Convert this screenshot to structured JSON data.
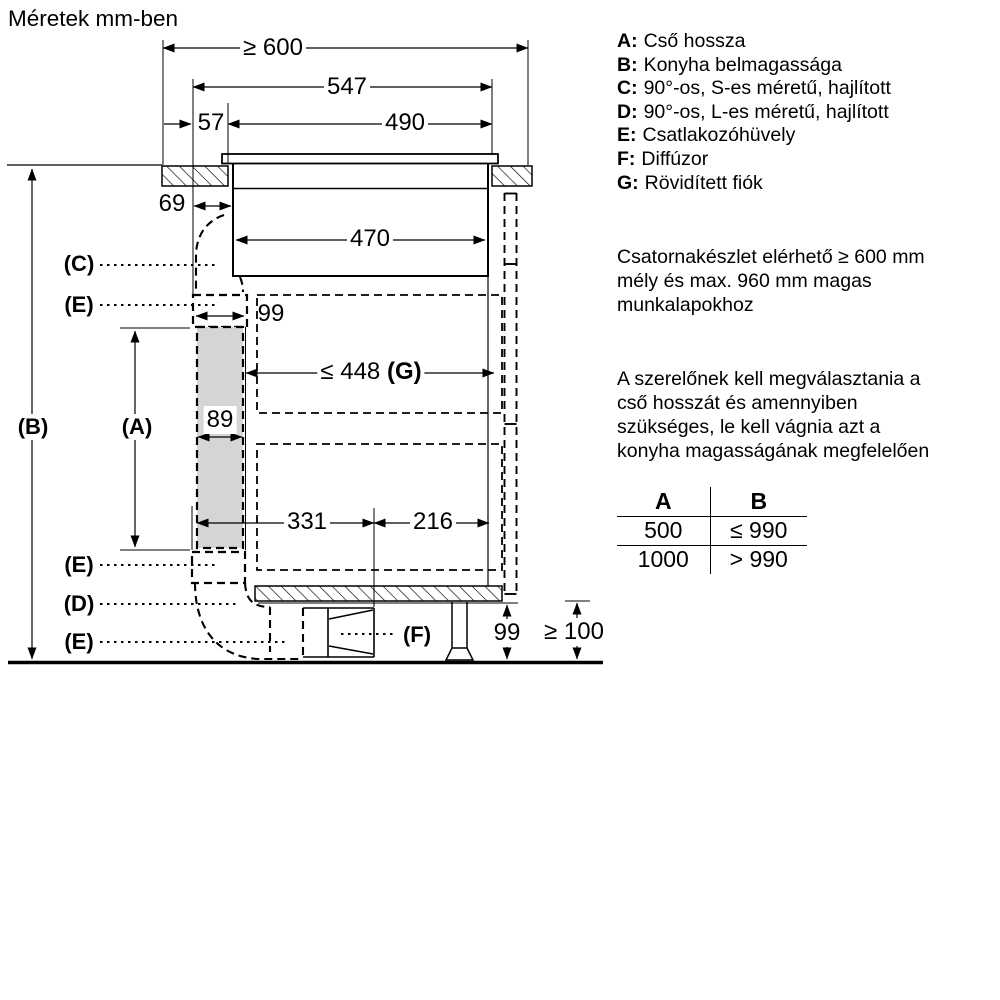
{
  "title": "Méretek mm-ben",
  "legend": {
    "items": [
      {
        "key": "A:",
        "text": "Cső hossza"
      },
      {
        "key": "B:",
        "text": "Konyha belmagassága"
      },
      {
        "key": "C:",
        "text": "90°-os, S-es méretű, hajlított"
      },
      {
        "key": "D:",
        "text": "90°-os, L-es méretű, hajlított"
      },
      {
        "key": "E:",
        "text": "Csatlakozóhüvely"
      },
      {
        "key": "F:",
        "text": "Diffúzor"
      },
      {
        "key": "G:",
        "text": "Rövidített fiók"
      }
    ]
  },
  "notes": {
    "note1_lines": [
      "Csatornakészlet elérhető ≥ 600 mm",
      "mély és max. 960 mm magas",
      "munkalapokhoz"
    ],
    "note2_lines": [
      "A szerelőnek kell megválasztania a",
      "cső hosszát és amennyiben",
      "szükséges, le kell vágnia azt a",
      "konyha magasságának megfelelően"
    ]
  },
  "table": {
    "headers": [
      "A",
      "B"
    ],
    "rows": [
      [
        "500",
        "≤ 990"
      ],
      [
        "1000",
        "> 990"
      ]
    ]
  },
  "dimensions": {
    "top_width": "≥ 600",
    "width_547": "547",
    "offset_57": "57",
    "cutout_490": "490",
    "offset_69": "69",
    "inner_470": "470",
    "connector_99": "99",
    "drawer_g_value": "≤ 448",
    "drawer_g_label": "(G)",
    "duct_89": "89",
    "bottom_331": "331",
    "bottom_216": "216",
    "plinth_99": "99",
    "clearance_100": "≥ 100"
  },
  "labels": {
    "a": "(A)",
    "b": "(B)",
    "c": "(C)",
    "d": "(D)",
    "e": "(E)",
    "f": "(F)"
  },
  "colors": {
    "ink": "#000000",
    "duct_fill": "#d5d5d5",
    "background": "#ffffff"
  }
}
